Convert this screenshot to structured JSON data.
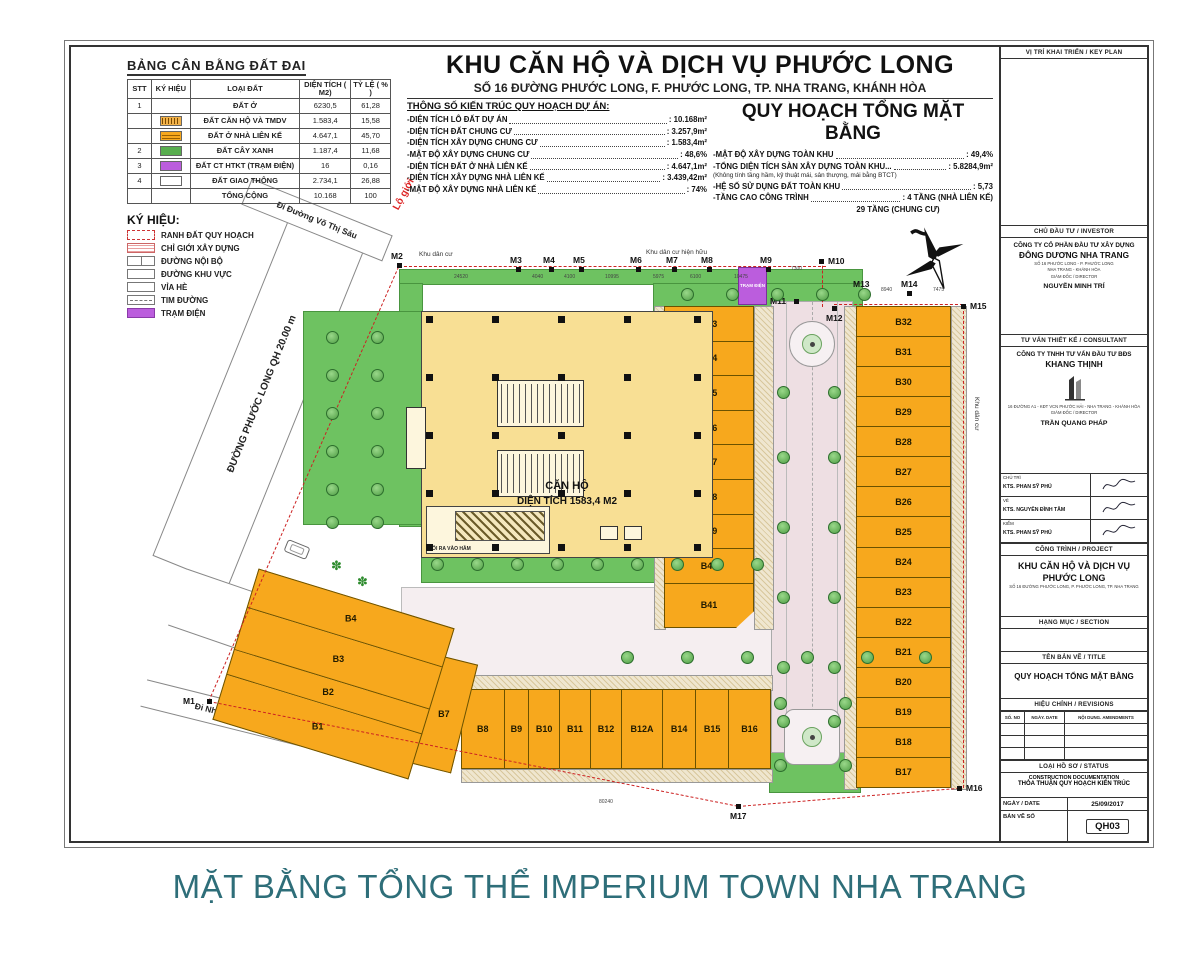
{
  "caption": "MẶT BẰNG TỔNG THỂ IMPERIUM TOWN NHA TRANG",
  "land_table": {
    "title": "BẢNG CÂN BẰNG ĐẤT ĐAI",
    "headers": [
      "STT",
      "KÝ HIỆU",
      "LOẠI ĐẤT",
      "DIỆN TÍCH ( M2)",
      "TỶ LỆ ( % )"
    ],
    "rows": [
      {
        "stt": "1",
        "swatch": "none",
        "loai": "ĐẤT Ở",
        "dt": "6230,5",
        "tl": "61,28"
      },
      {
        "stt": "",
        "swatch": "apartment",
        "loai": "ĐẤT CĂN HỘ VÀ TMDV",
        "dt": "1.583,4",
        "tl": "15,58"
      },
      {
        "stt": "",
        "swatch": "rowhouse",
        "loai": "ĐẤT Ở NHÀ LIÊN KẾ",
        "dt": "4.647,1",
        "tl": "45,70"
      },
      {
        "stt": "2",
        "swatch": "green",
        "loai": "ĐẤT CÂY XANH",
        "dt": "1.187,4",
        "tl": "11,68"
      },
      {
        "stt": "3",
        "swatch": "purple",
        "loai": "ĐẤT CT HTKT (TRẠM ĐIỆN)",
        "dt": "16",
        "tl": "0,16"
      },
      {
        "stt": "4",
        "swatch": "road",
        "loai": "ĐẤT GIAO THÔNG",
        "dt": "2.734,1",
        "tl": "26,88"
      },
      {
        "stt": "",
        "swatch": "none",
        "loai": "TỔNG CỘNG",
        "dt": "10.168",
        "tl": "100"
      }
    ]
  },
  "header": {
    "title": "KHU CĂN HỘ VÀ DỊCH VỤ PHƯỚC LONG",
    "subtitle": "SỐ 16 ĐƯỜNG PHƯỚC LONG, F. PHƯỚC LONG, TP. NHA TRANG, KHÁNH HÒA",
    "plan_title": "QUY HOẠCH TỔNG MẶT BẰNG",
    "specs_title": "THÔNG SỐ KIẾN TRÚC QUY HOẠCH DỰ ÁN:",
    "specs_left": [
      {
        "label": "-DIỆN TÍCH LÔ ĐẤT DỰ ÁN",
        "value": ": 10.168m²",
        "style": "normal"
      },
      {
        "label": "-DIỆN TÍCH ĐẤT CHUNG CƯ",
        "value": ": 3.257,9m²",
        "style": "normal"
      },
      {
        "label": "-DIỆN TÍCH XÂY DỰNG CHUNG CƯ",
        "value": ": 1.583,4m²",
        "style": "normal"
      },
      {
        "label": "-MẬT ĐỘ XÂY DỰNG CHUNG CƯ",
        "value": ": 48,6%",
        "style": "normal"
      },
      {
        "label": "-DIỆN TÍCH ĐẤT Ở NHÀ LIÊN KẾ",
        "value": ": 4.647,1m²",
        "style": "normal"
      },
      {
        "label": "-DIỆN TÍCH XÂY DỰNG NHÀ LIÊN KẾ",
        "value": ": 3.439,42m²",
        "style": "normal"
      },
      {
        "label": "-MẬT ĐỘ XÂY DỰNG NHÀ LIÊN KẾ",
        "value": ": 74%",
        "style": "normal"
      }
    ],
    "specs_right": [
      {
        "label": "-MẬT ĐỘ XÂY DỰNG TOÀN KHU",
        "value": ": 49,4%",
        "style": "normal"
      },
      {
        "label": "-TỔNG DIỆN TÍCH SÀN XÂY DỰNG TOÀN KHU...",
        "value": ": 5.8284,9m²",
        "style": "normal"
      },
      {
        "label": "(Không tính tầng hầm, kỹ thuật mái, sân thượng, mái bằng BTCT)",
        "value": "",
        "style": "note"
      },
      {
        "label": "-HỆ SỐ SỬ DỤNG ĐẤT TOÀN KHU",
        "value": ": 5,73",
        "style": "normal"
      },
      {
        "label": "-TẦNG CAO CÔNG TRÌNH",
        "value": ": 4 TẦNG (NHÀ LIÊN KẾ)",
        "style": "normal"
      },
      {
        "label": "29 TẦNG (CHUNG CƯ)",
        "value": "",
        "style": "cont"
      }
    ]
  },
  "legend": {
    "title": "KÝ HIỆU:",
    "items": [
      {
        "label": "RANH ĐẤT QUY HOẠCH",
        "type": "ranh"
      },
      {
        "label": "CHỈ GIỚI XÂY DỰNG",
        "type": "chigioi"
      },
      {
        "label": "ĐƯỜNG NỘI BỘ",
        "type": "noibo"
      },
      {
        "label": "ĐƯỜNG KHU VỰC",
        "type": "khuvuc"
      },
      {
        "label": "VỈA HÈ",
        "type": "viahe"
      },
      {
        "label": "TIM ĐƯỜNG",
        "type": "timduong"
      },
      {
        "label": "TRẠM ĐIỆN",
        "type": "tramdien"
      }
    ]
  },
  "plan": {
    "roads": {
      "phuoc_long": "ĐƯỜNG PHƯỚC LONG QH 20.00 m",
      "qh13": "ĐƯỜNG QH RỘNG 13m",
      "vo_thi_sau": "Đi Đường Võ Thị Sáu",
      "nha_may": "Đi Nhà máy đóng tàu"
    },
    "building": {
      "name": "CĂN HỘ",
      "area": "DIỆN TÍCH 1583,4 M2",
      "ramp": "LỐI RA VÀO HẦM"
    },
    "tram_dien": "TRẠM ĐIỆN",
    "labels": {
      "lo_gioi": "Lộ giới",
      "khu_dan_cu": "Khu dân cư",
      "khu_dan_cu_hh": "Khu dân cư hiện hữu",
      "khu_dan_cu_right": "Khu dân cư"
    },
    "lots_mid": [
      "B33",
      "B34",
      "B35",
      "B36",
      "B37",
      "B38",
      "B39",
      "B40",
      "B41"
    ],
    "lots_right": [
      "B32",
      "B31",
      "B30",
      "B29",
      "B28",
      "B27",
      "B26",
      "B25",
      "B24",
      "B23",
      "B22",
      "B21",
      "B20",
      "B19",
      "B18",
      "B17"
    ],
    "lots_bottom": [
      "B8",
      "B9",
      "B10",
      "B11",
      "B12",
      "B12A",
      "B14",
      "B15",
      "B16"
    ],
    "lots_b57": [
      "B5",
      "B6",
      "B7"
    ],
    "lots_b14": [
      "B4",
      "B3",
      "B2",
      "B1"
    ],
    "markers": [
      "M1",
      "M2",
      "M3",
      "M4",
      "M5",
      "M6",
      "M7",
      "M8",
      "M9",
      "M10",
      "M11",
      "M12",
      "M13",
      "M14",
      "M15",
      "M16",
      "M17"
    ],
    "dims_top": [
      "24520",
      "4040",
      "4100",
      "10995",
      "5975",
      "6100",
      "10475",
      "7300"
    ],
    "dims_extra": [
      "8940",
      "7475",
      "80240"
    ]
  },
  "titleblock": {
    "keyplan_header": "VỊ TRÍ KHAI TRIỂN / KEY PLAN",
    "investor_header": "CHỦ ĐẦU TƯ / INVESTOR",
    "investor_line1": "CÔNG TY CỔ PHẦN ĐẦU TƯ XÂY DỰNG",
    "investor_name": "ĐÔNG DƯƠNG NHA TRANG",
    "investor_addr1": "SỐ 16 PHƯỚC LONG - P. PHƯỚC LONG",
    "investor_addr2": "NHA TRANG - KHÁNH HÒA",
    "investor_role": "GIÁM ĐỐC / DIRECTOR",
    "investor_person": "NGUYỄN MINH TRÍ",
    "consultant_header": "TƯ VẤN THIẾT KẾ / CONSULTANT",
    "consultant_line1": "CÔNG TY TNHH TƯ VẤN ĐẦU TƯ BĐS",
    "consultant_name": "KHANG THỊNH",
    "consultant_addr1": "16 ĐƯỜNG A1 - KĐT VCN PHƯỚC HẢI - NHA TRANG - KHÁNH HÒA",
    "consultant_role": "GIÁM ĐỐC / DIRECTOR",
    "consultant_person": "TRẦN QUANG PHÁP",
    "sig_rows": [
      {
        "role": "CHỦ TRÌ",
        "name": "KTS. PHAN SỸ PHÚ"
      },
      {
        "role": "VẼ",
        "name": "KTS. NGUYỄN ĐÌNH TÂM"
      },
      {
        "role": "KIỂM",
        "name": "KTS. PHAN SỸ PHÚ"
      }
    ],
    "project_header": "CÔNG TRÌNH / PROJECT",
    "project_name1": "KHU CĂN HỘ VÀ DỊCH VỤ",
    "project_name2": "PHƯỚC LONG",
    "project_addr": "SỐ 16 ĐƯỜNG PHƯỚC LONG, P. PHƯỚC LONG, TP. NHA TRANG",
    "section_header": "HẠNG MỤC / SECTION",
    "title_header": "TÊN BẢN VẼ / TITLE",
    "drawing_title": "QUY HOẠCH TỔNG MẶT BẰNG",
    "revisions_header": "HIỆU CHỈNH / REVISIONS",
    "rev_cols": [
      "SỐ. NO",
      "NGÀY. DATE",
      "NỘI DUNG. AMENDMENTS"
    ],
    "status_header": "LOẠI HỒ SƠ / STATUS",
    "status_line1": "CONSTRUCTION DOCUMENTATION",
    "status_line2": "THỎA THUẬN QUY HOẠCH KIẾN TRÚC",
    "date_label": "NGÀY / DATE",
    "date_value": "25/09/2017",
    "number_label": "BẢN VẼ SỐ",
    "number_value": "QH03"
  }
}
